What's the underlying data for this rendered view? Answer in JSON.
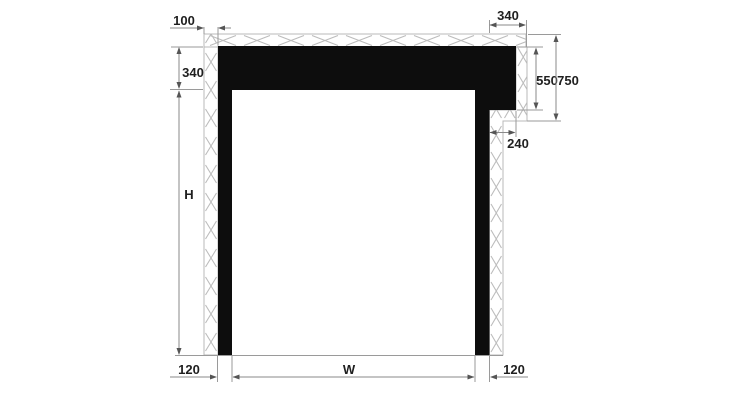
{
  "diagram": {
    "dimensions": {
      "wall_offset_top_left": "100",
      "head_height": "340",
      "opening_height": "H",
      "head_overlap_top_right": "340",
      "right_detail_inner": "550",
      "right_detail_outer": "750",
      "head_overhang": "240",
      "left_jamb_width": "120",
      "opening_width": "W",
      "right_jamb_width": "120"
    },
    "colors": {
      "background": "#ffffff",
      "frame": "#0d0d0d",
      "hatch": "#b8b8b8",
      "dimension_line": "#8a8a8a",
      "arrow": "#555555",
      "label_text": "#1f1f1f"
    }
  }
}
